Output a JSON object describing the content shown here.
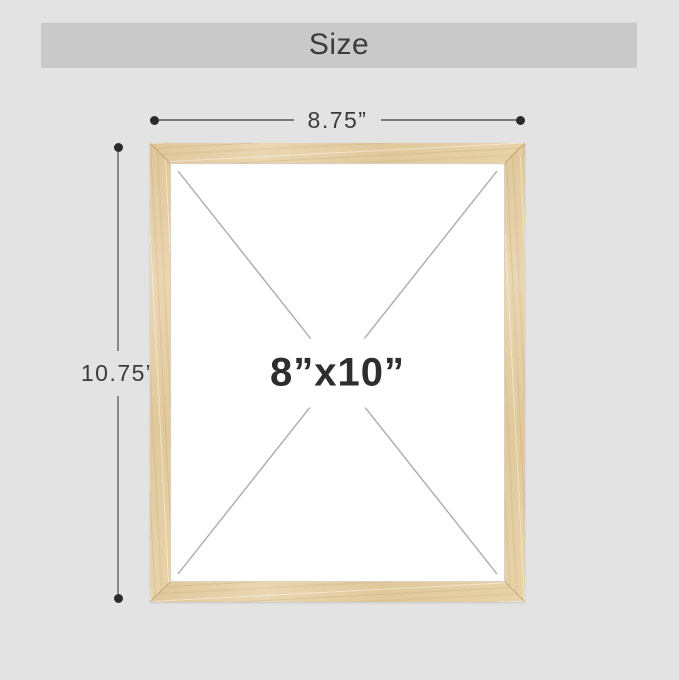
{
  "page": {
    "background_color": "#e3e3e3"
  },
  "header": {
    "title": "Size",
    "background_color": "#c9c9c9",
    "text_color": "#3c3c3c"
  },
  "dimensions": {
    "width": {
      "label": "8.75”"
    },
    "height": {
      "label": "10.75”"
    },
    "line_color": "#7a7a7a",
    "endpoint_dot_color": "#2b2b2b",
    "label_color": "#3b3b3b"
  },
  "frame": {
    "opening_label": "8”x10”",
    "label_color": "#2e2e2e",
    "wood_color": "#e6d0a6",
    "wood_grain_color": "#ab8146",
    "opening_background": "#ffffff",
    "cross_line_color": "#ababab"
  }
}
